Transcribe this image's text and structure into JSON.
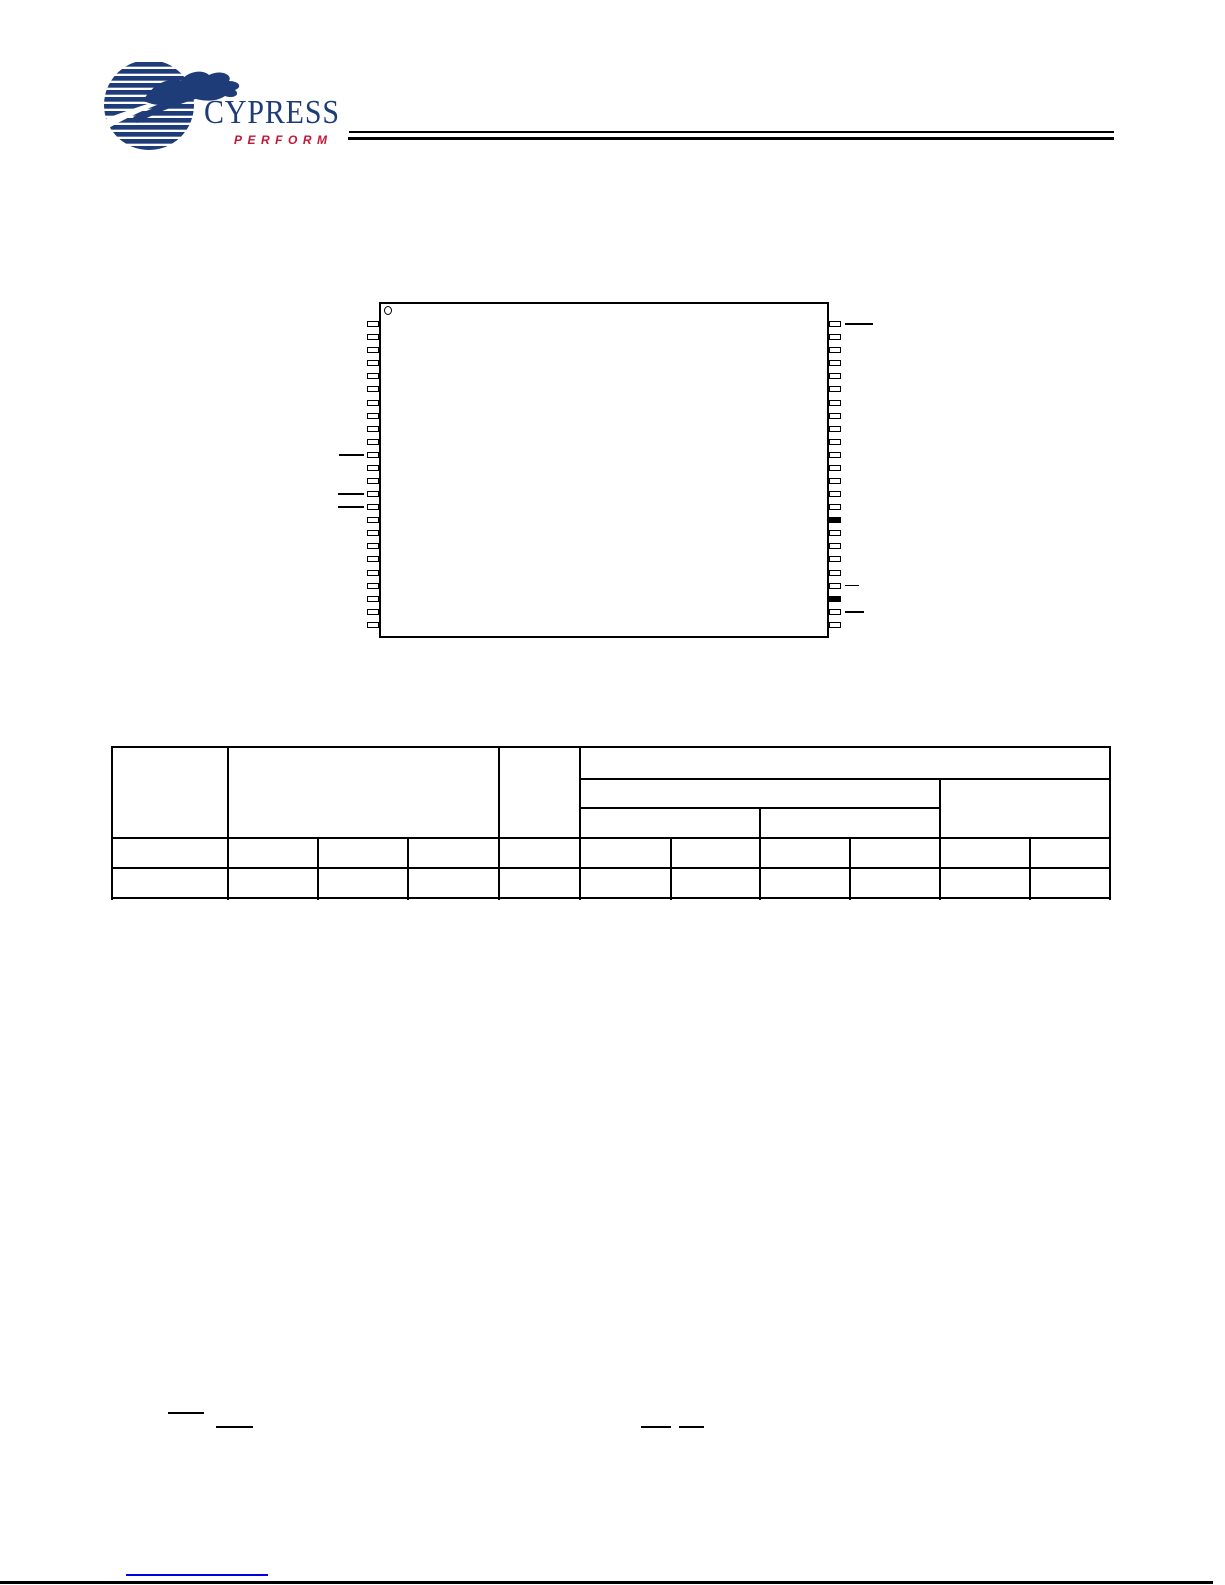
{
  "page": {
    "background": "#ffffff"
  },
  "logo": {
    "brand": "CYPRESS",
    "tagline": "PERFORM",
    "navy": "#1e3c78",
    "red": "#c41735"
  },
  "diagram": {
    "type": "chip-pinout",
    "pins_per_side": 24,
    "pin1_indicator": "circle-top-left",
    "right_filled_pins": [
      16,
      22
    ],
    "left_leaders": [
      {
        "pin": 11,
        "len": 25
      },
      {
        "pin": 14,
        "len": 26
      },
      {
        "pin": 15,
        "len": 26
      }
    ],
    "right_leaders": [
      {
        "pin": 1,
        "len": 28
      },
      {
        "pin": 21,
        "len": 14
      },
      {
        "pin": 23,
        "len": 19
      }
    ]
  },
  "table": {
    "columns": 11,
    "header_bands": 3,
    "body_rows": 2,
    "cells_empty": true,
    "grid": {
      "x": 112,
      "y": 747,
      "w": 998,
      "h": 151,
      "v_lines": [
        [
          0,
          0,
          151
        ],
        [
          116,
          0,
          151
        ],
        [
          206,
          91,
          151
        ],
        [
          296,
          91,
          151
        ],
        [
          387,
          0,
          151
        ],
        [
          468,
          0,
          151
        ],
        [
          559,
          91,
          151
        ],
        [
          648,
          61,
          151
        ],
        [
          738,
          91,
          151
        ],
        [
          828,
          32,
          151
        ],
        [
          918,
          91,
          151
        ],
        [
          998,
          0,
          151
        ]
      ],
      "h_lines": [
        [
          0,
          0,
          998
        ],
        [
          32,
          468,
          998
        ],
        [
          61,
          468,
          828
        ],
        [
          91,
          0,
          998
        ],
        [
          121,
          0,
          998
        ],
        [
          151,
          0,
          998
        ]
      ]
    }
  },
  "overbars": [
    {
      "x": 168,
      "y": 1412,
      "w": 36
    },
    {
      "x": 216,
      "y": 1426,
      "w": 37
    },
    {
      "x": 641,
      "y": 1426,
      "w": 30
    },
    {
      "x": 679,
      "y": 1426,
      "w": 25
    }
  ],
  "footer": {
    "link_color": "#0000e8"
  }
}
